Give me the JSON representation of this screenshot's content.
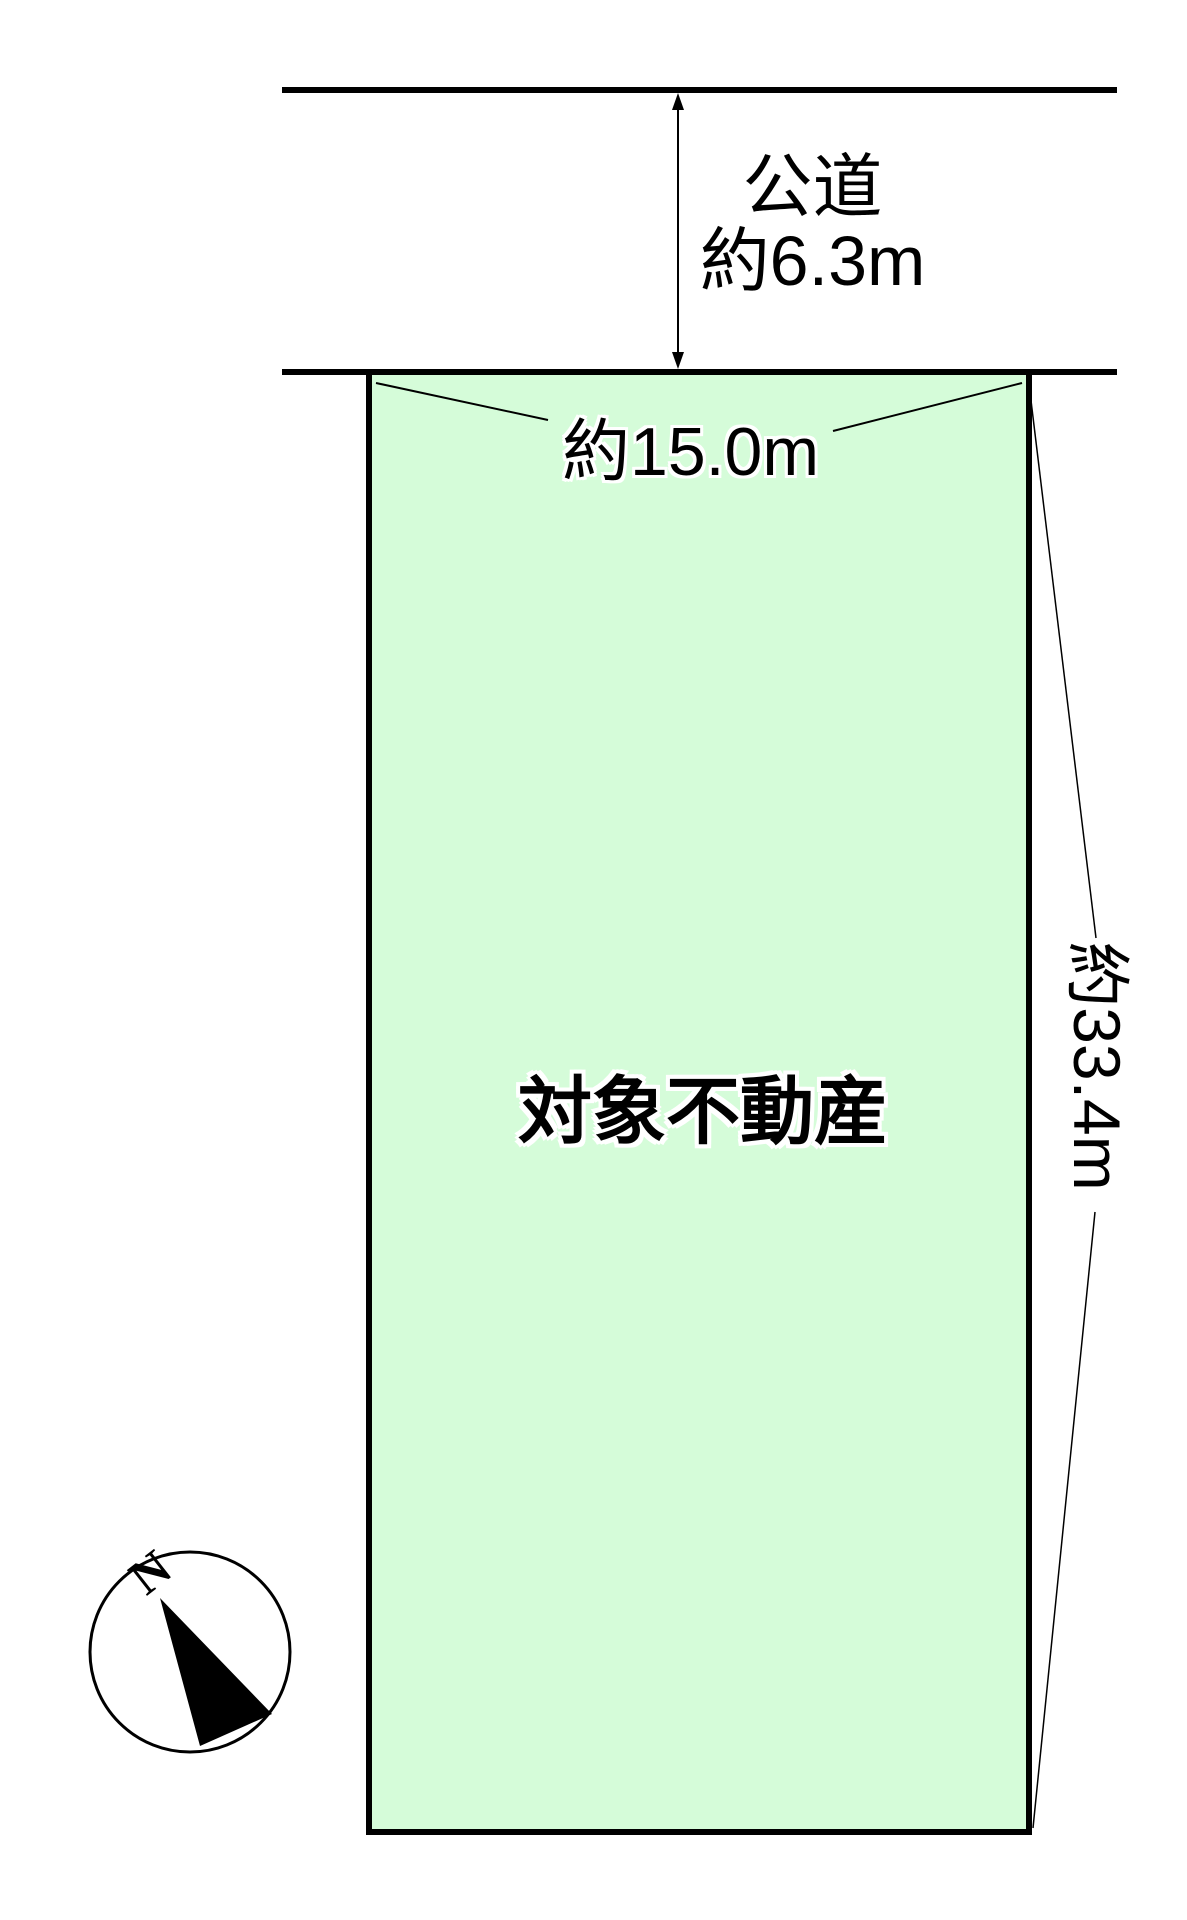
{
  "diagram": {
    "road": {
      "name_label": "公道",
      "width_label": "約6.3m"
    },
    "lot": {
      "property_label": "対象不動産",
      "frontage_label": "約15.0m",
      "depth_label": "約33.4m"
    },
    "compass": {
      "north_label": "N"
    }
  },
  "colors": {
    "background": "#ffffff",
    "lot_fill": "#d5fcd9",
    "line": "#000000",
    "compass_fill": "#ffffff"
  }
}
